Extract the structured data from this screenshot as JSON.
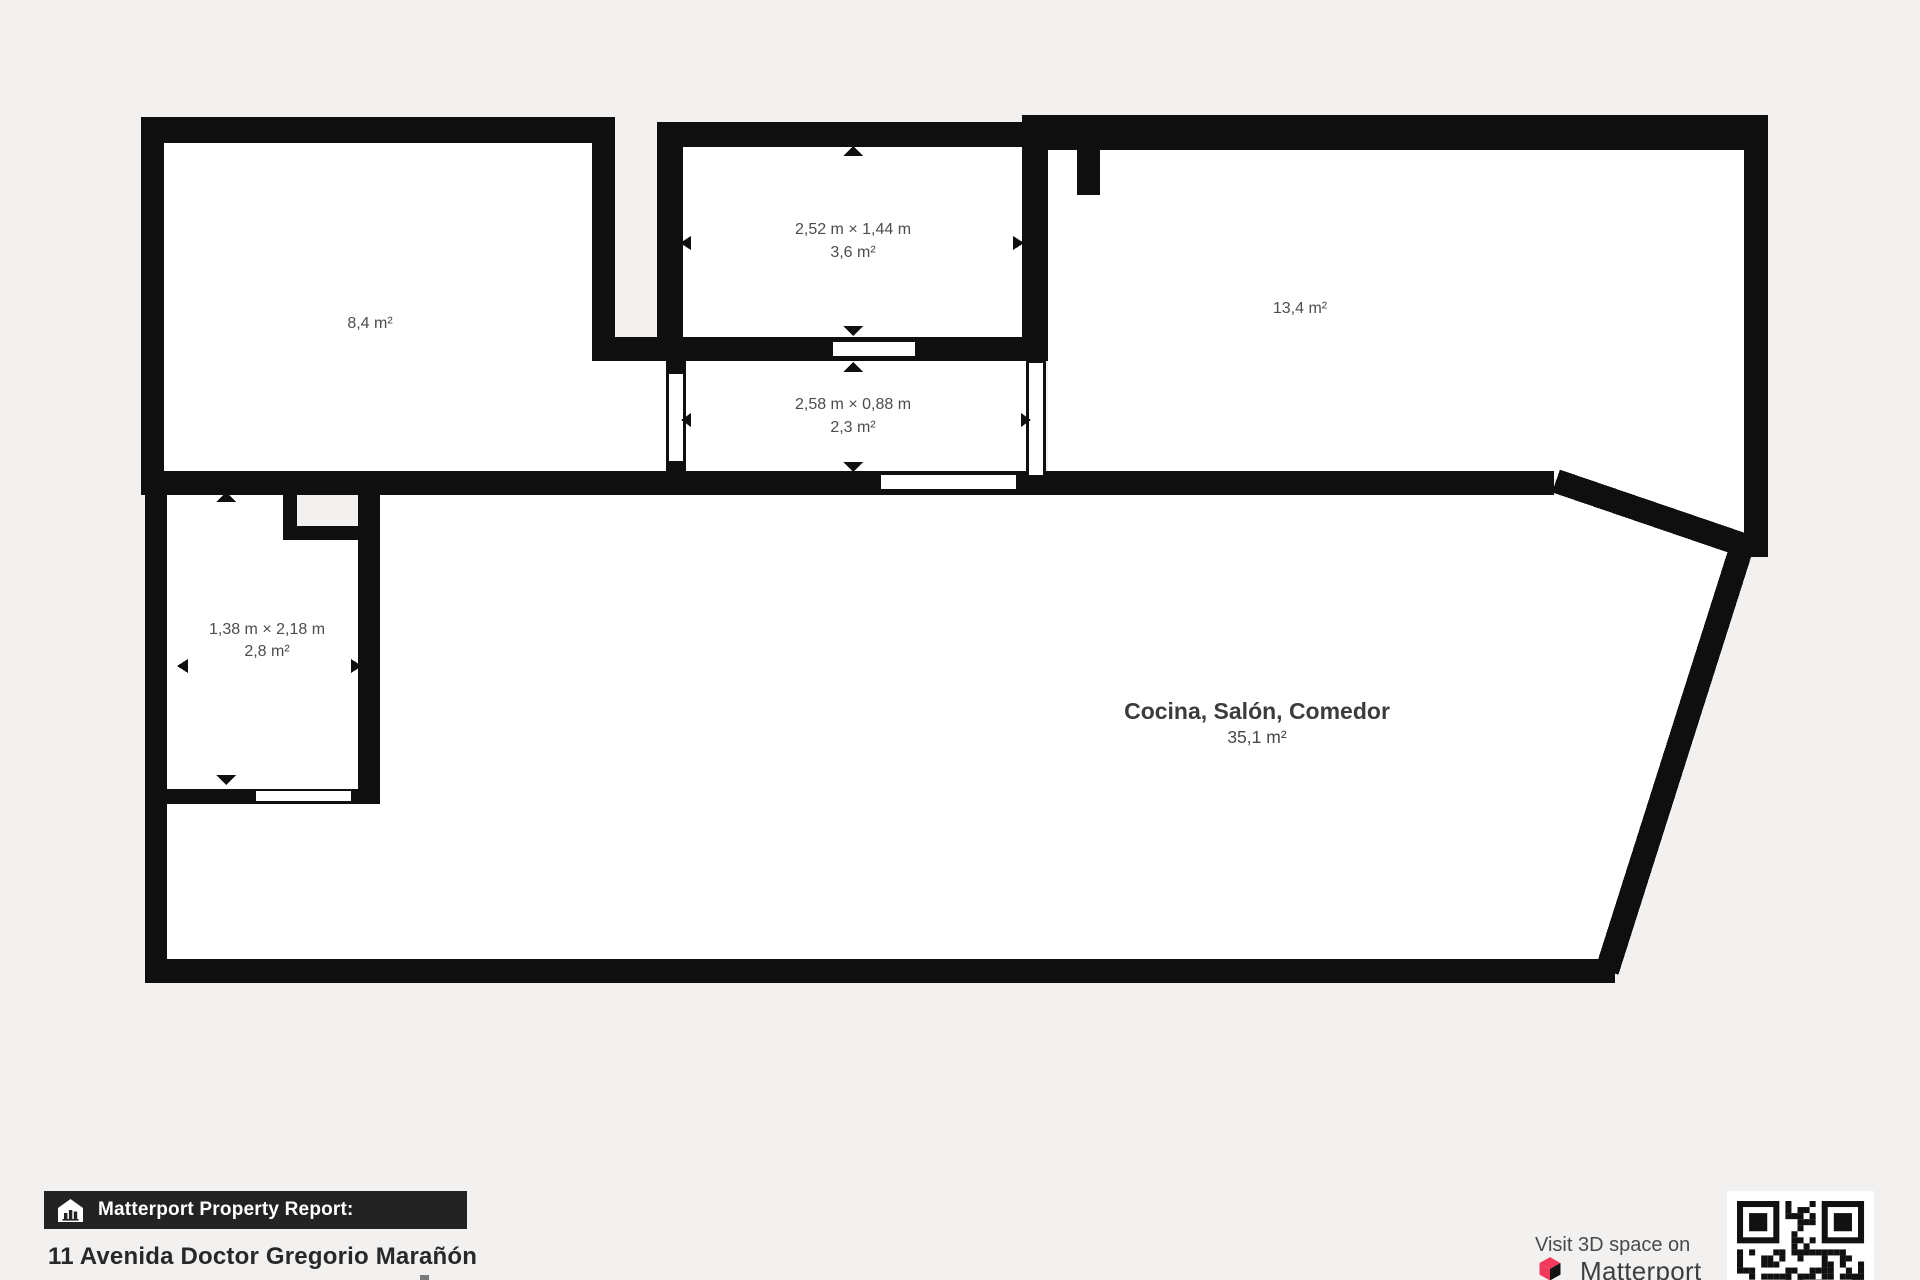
{
  "floorplan": {
    "rooms": [
      {
        "key": "room-top-left",
        "area": "8,4 m²"
      },
      {
        "key": "room-top-middle",
        "dims": "2,52 m × 1,44 m",
        "area": "3,6 m²"
      },
      {
        "key": "room-top-right",
        "area": "13,4 m²"
      },
      {
        "key": "hallway",
        "dims": "2,58 m × 0,88 m",
        "area": "2,3 m²"
      },
      {
        "key": "room-left-small",
        "dims": "1,38 m × 2,18 m",
        "area": "2,8 m²"
      },
      {
        "key": "main-room",
        "name": "Cocina, Salón, Comedor",
        "area": "35,1 m²"
      }
    ]
  },
  "footer": {
    "badge_label": "Matterport Property Report:",
    "address": "11 Avenida Doctor Gregorio Marañón",
    "visit_3d": "Visit 3D space on",
    "brand": "Matterport"
  },
  "icons": {
    "badge_icon": "house-with-bar-chart",
    "brand_icon": "matterport-cube",
    "qr": "qr-code"
  },
  "colors": {
    "background": "#f2f1ef",
    "wall": "#0f0f0f",
    "room_fill": "#ffffff",
    "label_text": "#4c4c4c",
    "badge_bg": "#232323",
    "accent_pink": "#f43a5c"
  }
}
